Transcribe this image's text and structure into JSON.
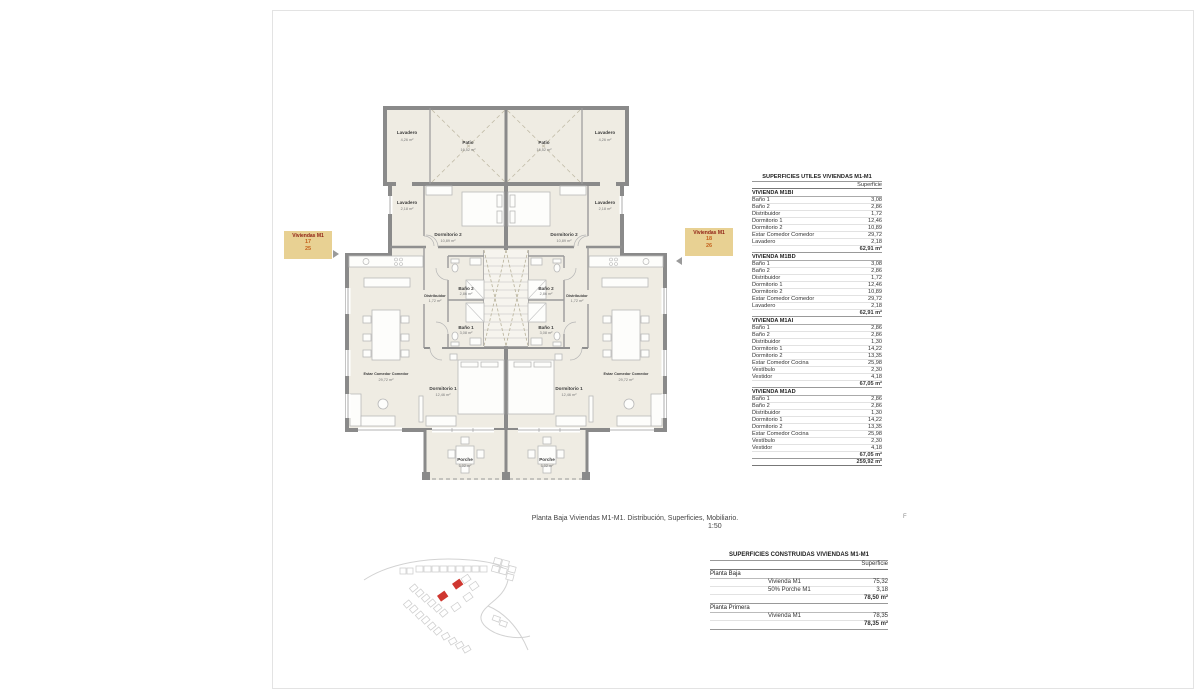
{
  "sheet": {
    "caption_line1": "Planta Baja Viviendas M1-M1. Distribución, Superficies, Mobiliario.",
    "caption_scale": "1:50",
    "margin_mark": "F"
  },
  "tags": {
    "left": {
      "title": "Viviendas M1",
      "num1": "17",
      "num2": "25"
    },
    "right": {
      "title": "Viviendas M1",
      "num1": "18",
      "num2": "26"
    }
  },
  "plan": {
    "rooms": {
      "lavadero_patio": {
        "name": "Lavadero",
        "area": "4,26 m²"
      },
      "patio": {
        "name": "Patio",
        "area": "16,52 m²"
      },
      "lavadero": {
        "name": "Lavadero",
        "area": "2,18 m²"
      },
      "dormitorio2": {
        "name": "Dormitorio 2",
        "area": "10,89 m²"
      },
      "bano2": {
        "name": "Baño 2",
        "area": "2,86 m²"
      },
      "distribuidor": {
        "name": "Distribuidor",
        "area": "1,72 m²"
      },
      "bano1": {
        "name": "Baño 1",
        "area": "3,08 m²"
      },
      "dormitorio1": {
        "name": "Dormitorio 1",
        "area": "12,46 m²"
      },
      "estar": {
        "name": "Estar Comedor Comedor",
        "area": "29,72 m²"
      },
      "porche": {
        "name": "Porche",
        "area": "6,02 m²"
      }
    }
  },
  "tables": {
    "utiles": {
      "title": "SUPERFICIES UTILES VIVIENDAS M1-M1",
      "col": "Superficie",
      "blocks": [
        {
          "name": "VIVIENDA M1BI",
          "rows": [
            [
              "Baño 1",
              "3,08"
            ],
            [
              "Baño 2",
              "2,86"
            ],
            [
              "Distribuidor",
              "1,72"
            ],
            [
              "Dormitorio 1",
              "12,46"
            ],
            [
              "Dormitorio 2",
              "10,89"
            ],
            [
              "Estar Comedor Comedor",
              "29,72"
            ],
            [
              "Lavadero",
              "2,18"
            ]
          ],
          "total": "62,91 m²"
        },
        {
          "name": "VIVIENDA M1BD",
          "rows": [
            [
              "Baño 1",
              "3,08"
            ],
            [
              "Baño 2",
              "2,86"
            ],
            [
              "Distribuidor",
              "1,72"
            ],
            [
              "Dormitorio 1",
              "12,46"
            ],
            [
              "Dormitorio 2",
              "10,89"
            ],
            [
              "Estar Comedor Comedor",
              "29,72"
            ],
            [
              "Lavadero",
              "2,18"
            ]
          ],
          "total": "62,91 m²"
        },
        {
          "name": "VIVIENDA M1AI",
          "rows": [
            [
              "Baño 1",
              "2,86"
            ],
            [
              "Baño 2",
              "2,86"
            ],
            [
              "Distribuidor",
              "1,30"
            ],
            [
              "Dormitorio 1",
              "14,22"
            ],
            [
              "Dormitorio 2",
              "13,35"
            ],
            [
              "Estar Comedor Cocina",
              "25,98"
            ],
            [
              "Vestíbulo",
              "2,30"
            ],
            [
              "Vestidor",
              "4,18"
            ]
          ],
          "total": "67,05 m²"
        },
        {
          "name": "VIVIENDA M1AD",
          "rows": [
            [
              "Baño 1",
              "2,86"
            ],
            [
              "Baño 2",
              "2,86"
            ],
            [
              "Distribuidor",
              "1,30"
            ],
            [
              "Dormitorio 1",
              "14,22"
            ],
            [
              "Dormitorio 2",
              "13,35"
            ],
            [
              "Estar Comedor Cocina",
              "25,98"
            ],
            [
              "Vestíbulo",
              "2,30"
            ],
            [
              "Vestidor",
              "4,18"
            ]
          ],
          "total": "67,05 m²"
        }
      ],
      "grand_total": "259,92 m²"
    },
    "construidas": {
      "title": "SUPERFICIES CONSTRUIDAS VIVIENDAS M1-M1",
      "col": "Superficie",
      "sections": [
        {
          "name": "Planta Baja",
          "rows": [
            [
              "Vivienda M1",
              "75,32"
            ],
            [
              "50% Porche M1",
              "3,18"
            ]
          ],
          "total": "78,50 m²"
        },
        {
          "name": "Planta Primera",
          "rows": [
            [
              "Vivienda M1",
              "78,35"
            ]
          ],
          "total": "78,35 m²"
        }
      ]
    }
  },
  "colors": {
    "tag_bg": "#e8d193",
    "tag_title": "#8d1d12",
    "tag_number": "#c4611c",
    "highlight_red": "#cf3730",
    "wall_gray": "#8a8a8a",
    "floor_beige": "#efece3"
  }
}
